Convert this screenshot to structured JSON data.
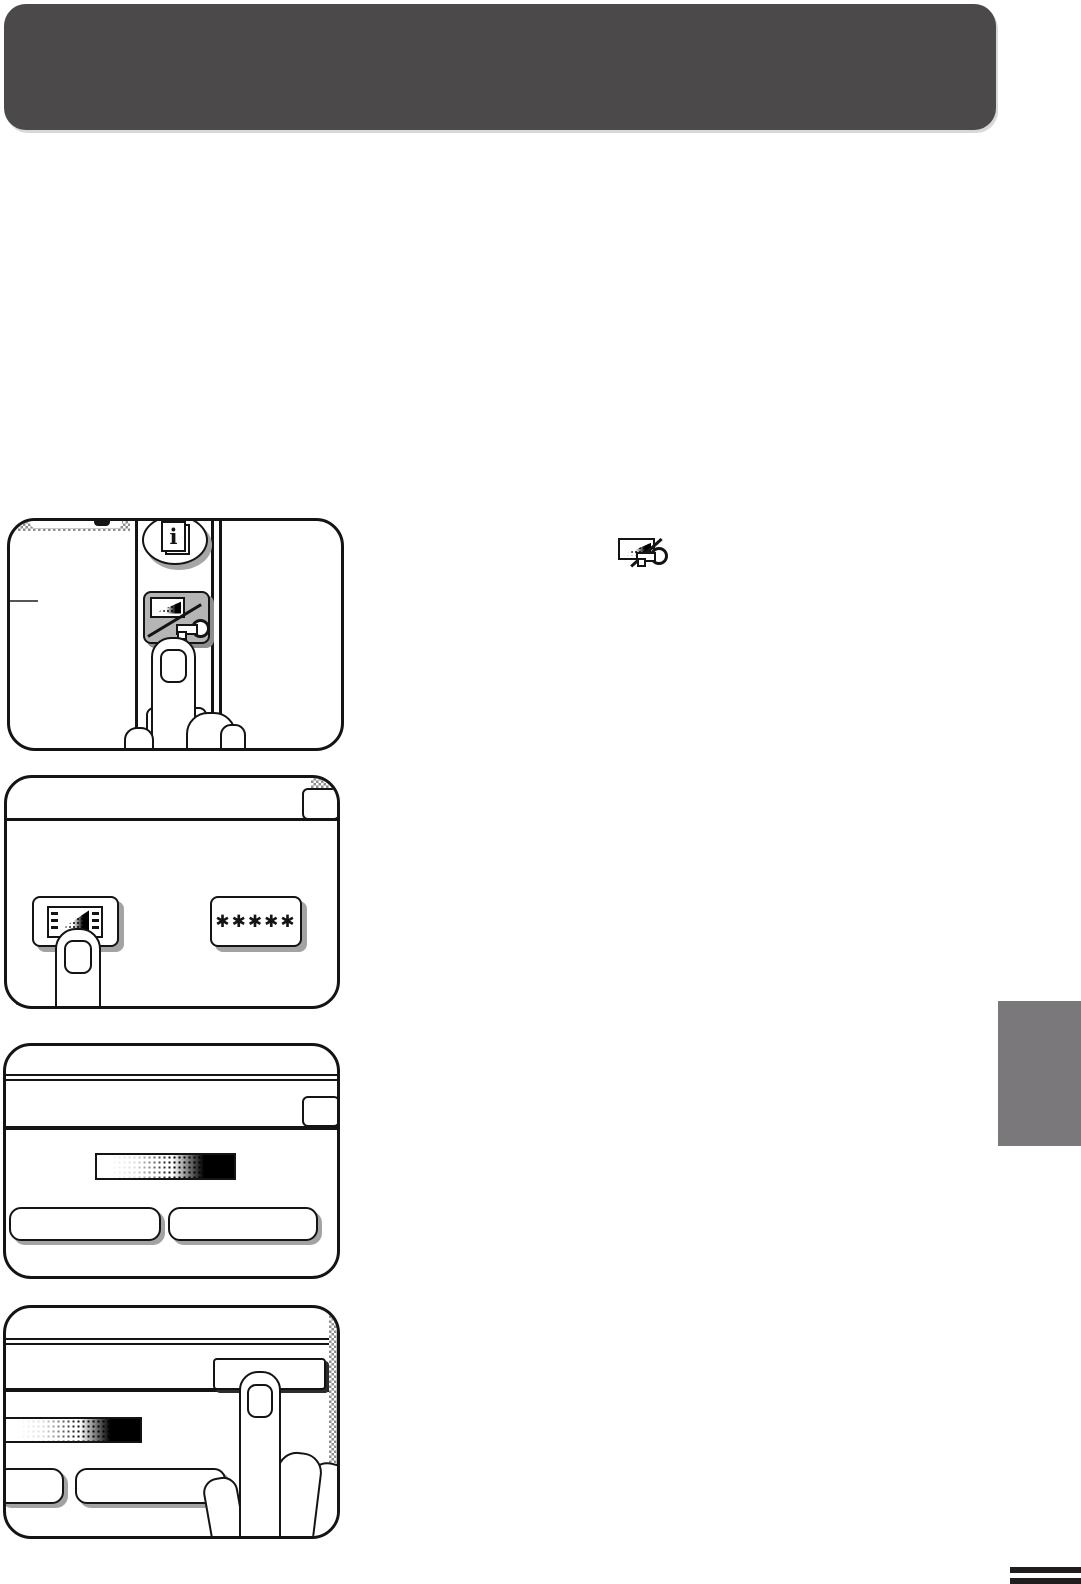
{
  "document": {
    "kind": "copier-operation-manual-page",
    "banner_color": "#4b494a",
    "side_tab_color": "#7a787a",
    "footer_mark_color": "#211d1e",
    "line_color": "#141414",
    "key_button_gray": "#b5b5b5"
  },
  "inline_icon": "exposure-key-icon",
  "panels": {
    "step1": {
      "name": "press-auditing-exposure-key",
      "info_glyph": "i",
      "icons": [
        "information-button-icon",
        "exposure-key-icon"
      ]
    },
    "step2": {
      "name": "touch-exposure-display-key",
      "password_label": "✱✱✱✱✱",
      "icons": [
        "exposure-display-icon",
        "asterisk-code-display"
      ]
    },
    "step3": {
      "name": "exposure-scale-screen",
      "icons": [
        "exposure-gradient-bar"
      ]
    },
    "step4": {
      "name": "touch-ok-key",
      "icons": [
        "exposure-gradient-bar",
        "pressing-hand"
      ]
    }
  }
}
